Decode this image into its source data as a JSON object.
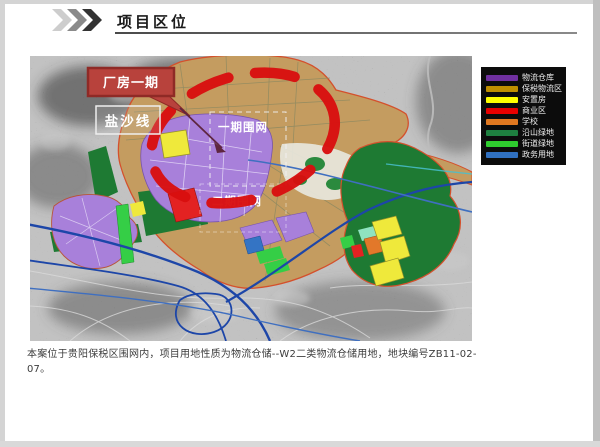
{
  "header": {
    "title": "项目区位"
  },
  "map": {
    "callout_label": "厂房一期",
    "road_label": "盐沙线",
    "fence_label_upper": "一期围网",
    "fence_label_lower": "二期围网"
  },
  "legend": {
    "items": [
      {
        "label": "物流仓库",
        "color": "#7030A0"
      },
      {
        "label": "保税物流区",
        "color": "#BF8F00"
      },
      {
        "label": "安置房",
        "color": "#FFFF00"
      },
      {
        "label": "商业区",
        "color": "#E80000"
      },
      {
        "label": "学校",
        "color": "#E07820"
      },
      {
        "label": "沿山绿地",
        "color": "#1E8040"
      },
      {
        "label": "街道绿地",
        "color": "#2ECC2E"
      },
      {
        "label": "政务用地",
        "color": "#3070C0"
      }
    ]
  },
  "caption": {
    "text": "本案位于贵阳保税区围网内，项目用地性质为物流仓储--W2二类物流仓储用地，地块编号ZB11-02-07。"
  },
  "colors": {
    "highlight_dash": "#D80F0F",
    "callout_fill": "#B8423C",
    "plan_boundary": "#D4502C",
    "warehouse_zone": "#A880DA"
  }
}
